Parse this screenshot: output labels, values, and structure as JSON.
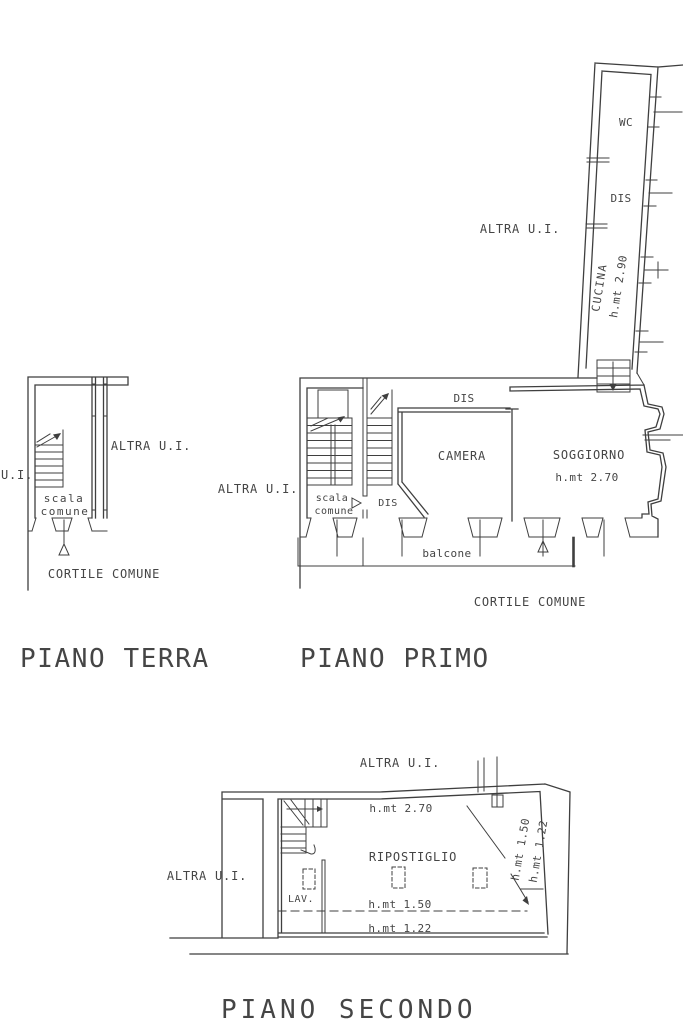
{
  "sheet": {
    "background": "#ffffff",
    "line_color": "#3f3f3f",
    "text_color": "#454545",
    "type": "architectural floor plan, three floors"
  },
  "terra": {
    "title": "PIANO TERRA",
    "labels": {
      "altra_ui": "ALTRA U.I.",
      "ui_partial": "U.I.",
      "scala": "scala",
      "comune": "comune",
      "cortile": "CORTILE COMUNE"
    }
  },
  "primo": {
    "title": "PIANO PRIMO",
    "labels": {
      "wc": "WC",
      "dis_wing": "DIS",
      "cucina": "CUCINA",
      "cucina_height": "h.mt 2.90",
      "altra_ui_wing": "ALTRA U.I.",
      "altra_ui_left": "ALTRA U.I.",
      "dis_top": "DIS",
      "camera": "CAMERA",
      "soggiorno": "SOGGIORNO",
      "soggiorno_height": "h.mt 2.70",
      "scala": "scala",
      "comune": "comune",
      "dis_mid": "DIS",
      "balcone": "balcone",
      "cortile": "CORTILE COMUNE"
    }
  },
  "secondo": {
    "title": "PIANO SECONDO",
    "labels": {
      "altra_ui_top": "ALTRA U.I.",
      "altra_ui_left": "ALTRA U.I.",
      "height_270": "h.mt 2.70",
      "ripostiglio": "RIPOSTIGLIO",
      "lav": "LAV.",
      "height_150": "h.mt 1.50",
      "height_122": "h.mt 1.22",
      "height_150_rot": "h.mt 1.50",
      "height_122_rot": "h.mt 1.22"
    }
  }
}
